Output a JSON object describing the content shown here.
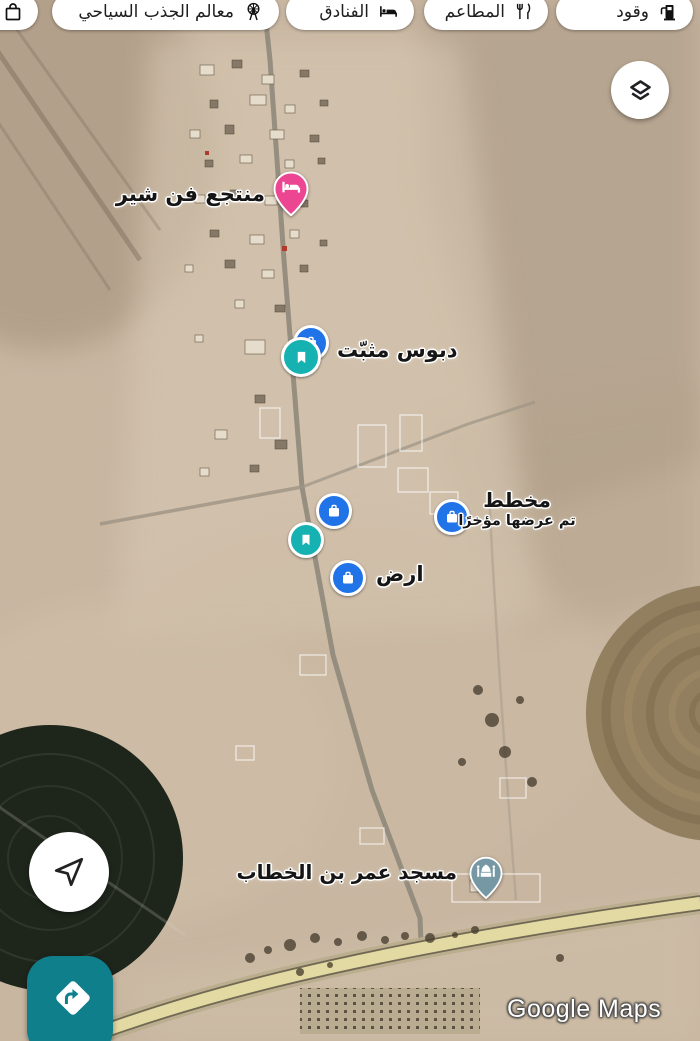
{
  "chips": [
    {
      "label": "وقود",
      "icon": "fuel-icon"
    },
    {
      "label": "المطاعم",
      "icon": "restaurants-icon"
    },
    {
      "label": "الفنادق",
      "icon": "hotels-icon"
    },
    {
      "label": "معالم الجذب السياحي",
      "icon": "attractions-icon"
    },
    {
      "label": "",
      "icon": "shopping-icon"
    }
  ],
  "markers": {
    "resort": {
      "label": "منتجع فن شير",
      "color": "#ec4693",
      "icon": "bed-icon"
    },
    "pinned_pin": {
      "label": "دبوس مثبّت",
      "color": "#16b1b1",
      "icon": "bookmark-icon"
    },
    "saved_place": {
      "color": "#2173e8",
      "icon": "suitcase-icon"
    },
    "saved_bookmark": {
      "color": "#16b1b1",
      "icon": "bookmark-icon"
    },
    "plan": {
      "label": "مخطط",
      "sublabel": "تم عرضها مؤخرًا",
      "color": "#2173e8",
      "icon": "suitcase-icon"
    },
    "land": {
      "label": "ارض",
      "color": "#2173e8",
      "icon": "suitcase-icon"
    },
    "mosque": {
      "label": "مسجد عمر بن الخطاب",
      "color": "#7598a4",
      "icon": "mosque-icon"
    }
  },
  "watermark": "Google Maps",
  "colors": {
    "chip_background": "#ffffff",
    "fab_teal": "#0f7f8c",
    "marker_blue": "#2173e8",
    "marker_teal": "#16b1b1",
    "marker_pink": "#ec4693",
    "marker_mosque": "#7598a4",
    "sand": "#c8b6a1"
  }
}
